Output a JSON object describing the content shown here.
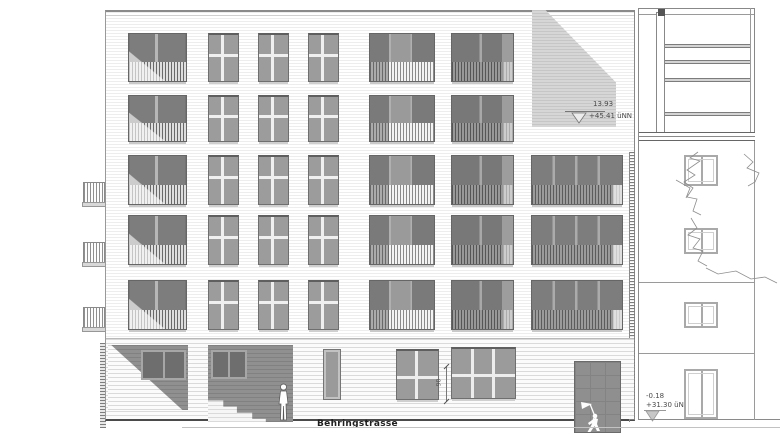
{
  "annotations": {
    "roof_level": {
      "dim": "13.93",
      "elev": "+45.41 üNN"
    },
    "street_level": {
      "dim": "-0.18",
      "elev": "+31.30 üNN"
    },
    "window_dim": "90",
    "street_name": "Behringstrasse"
  },
  "colors": {
    "glass_dark": "#7d7d7d",
    "glass_mid": "#9c9c9c",
    "shadow": "#d6d6d6",
    "recess_dark": "#8a8a8a",
    "line": "#888888"
  },
  "icons": {
    "standing_person": "person-silhouette",
    "door_figure": "flag-figure-graffiti",
    "tree": "tree-branch-sketch"
  }
}
